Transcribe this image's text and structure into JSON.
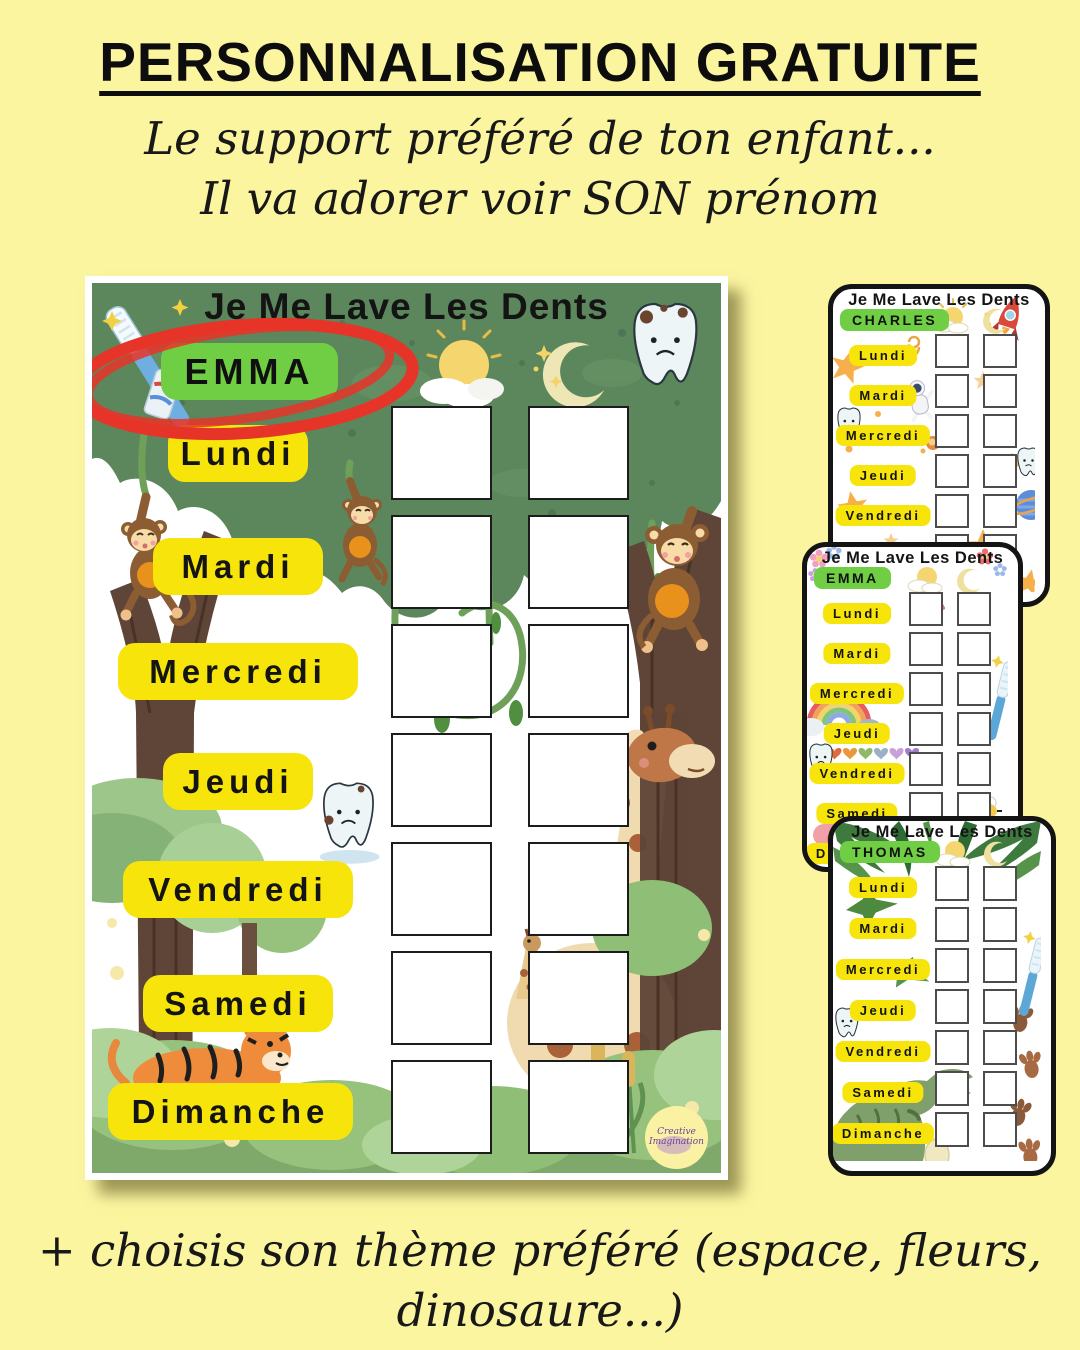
{
  "page": {
    "title": "PERSONNALISATION GRATUITE",
    "subtitle_line1": "Le support préféré de ton enfant...",
    "subtitle_line2": "Il va adorer voir SON prénom",
    "footer_line1": "+ choisis son thème préféré (espace, fleurs,",
    "footer_line2": "dinosaure...)"
  },
  "chart_title": "Je Me Lave Les Dents",
  "days": [
    "Lundi",
    "Mardi",
    "Mercredi",
    "Jeudi",
    "Vendredi",
    "Samedi",
    "Dimanche"
  ],
  "main_chart": {
    "name": "EMMA",
    "theme": "jungle",
    "columns": 2,
    "rows": 7,
    "logo_line1": "Creative",
    "logo_line2": "Imagination"
  },
  "mini_charts": [
    {
      "name": "CHARLES",
      "theme": "espace"
    },
    {
      "name": "EMMA",
      "theme": "fleurs"
    },
    {
      "name": "THOMAS",
      "theme": "dinosaure"
    }
  ],
  "colors": {
    "background": "#FCF5A0",
    "day_pill_yellow": "#F6E40A",
    "name_pill_green": "#70CE45",
    "highlight_red": "#E73428",
    "canopy_green": "#5C875C",
    "card_border": "#141414"
  }
}
